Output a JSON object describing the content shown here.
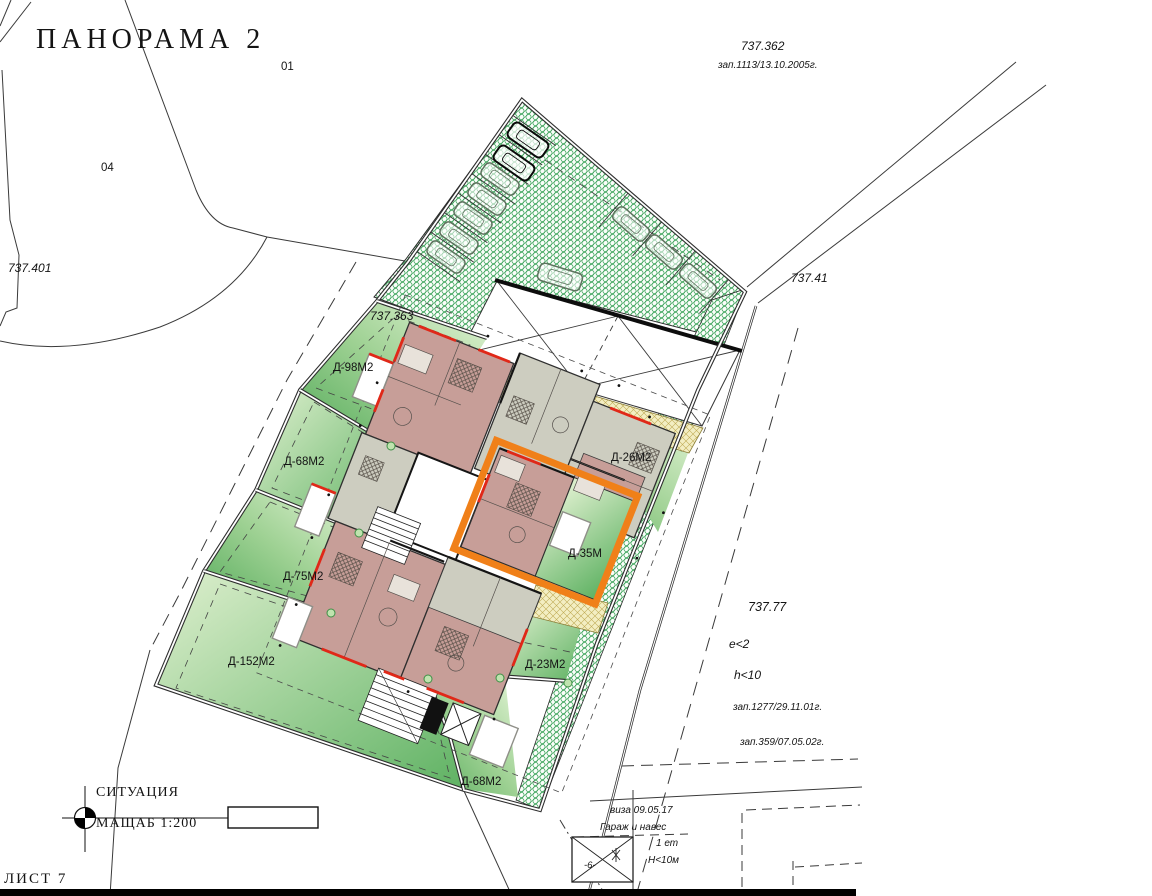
{
  "title": "ПАНОРАМА 2",
  "parcels": {
    "p01": "01",
    "p04": "04",
    "n737_401": "737.401",
    "n737_362": "737.362",
    "reg_1113": "зап.1113/13.10.2005г.",
    "n737_41": "737.41",
    "n737_363": "737.363",
    "n737_77": "737.77",
    "e_limit": "e<2",
    "h_limit": "h<10",
    "reg_1277": "зап.1277/29.11.01г.",
    "reg_359": "зап.359/07.05.02г."
  },
  "plots": [
    {
      "id": "d98",
      "label": "Д-98М2"
    },
    {
      "id": "d68l",
      "label": "Д-68М2"
    },
    {
      "id": "d75",
      "label": "Д-75М2"
    },
    {
      "id": "d152",
      "label": "Д-152М2"
    },
    {
      "id": "d68b",
      "label": "Д-68М2"
    },
    {
      "id": "d23",
      "label": "Д-23М2"
    },
    {
      "id": "d26",
      "label": "Д-26М2"
    }
  ],
  "highlight": {
    "label": "Д-35М",
    "color": "#f08019"
  },
  "notes": {
    "visa": "виза 09.05.17",
    "garage": "Гараж и навес",
    "floors": "1 ет",
    "height": "H<10м",
    "garage_mark": "-6-"
  },
  "titleblock": {
    "drawing": "СИТУАЦИЯ",
    "scale": "МАЩАБ 1:200",
    "sheet": "ЛИСТ 7"
  },
  "colors": {
    "highlight_orange": "#f08019",
    "plot_green_dark": "#55ab5b",
    "plot_green_light": "#e3f4d6",
    "hatch_green": "#2f9e4f",
    "room_mauve": "#c79e98",
    "room_gray": "#cdcdc0",
    "accent_red": "#e02818",
    "path_yellow": "#f3eec2"
  }
}
